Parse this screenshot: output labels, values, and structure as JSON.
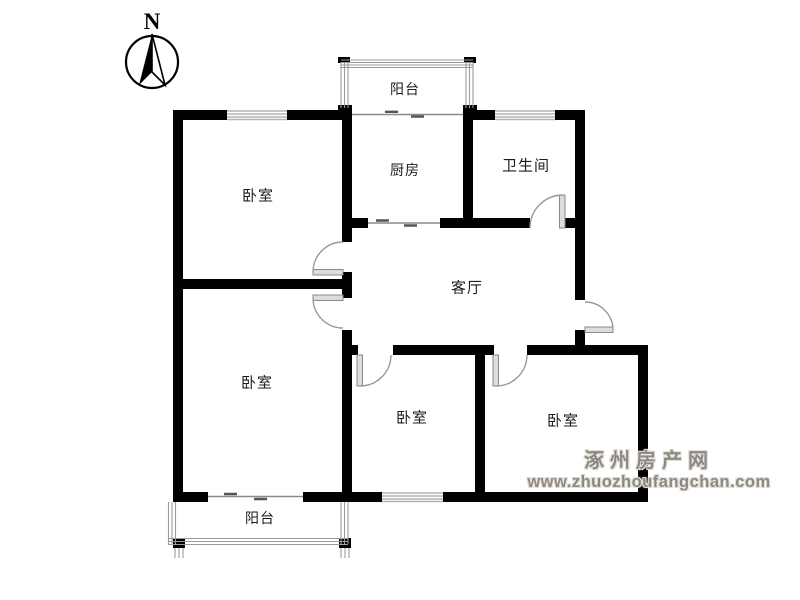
{
  "page": {
    "background": "#ffffff",
    "type": "apartment floor plan"
  },
  "compass": {
    "label": "N"
  },
  "rooms": [
    {
      "id": "balcony-north",
      "label": "阳台"
    },
    {
      "id": "kitchen",
      "label": "厨房"
    },
    {
      "id": "bathroom",
      "label": "卫生间"
    },
    {
      "id": "bedroom-northwest",
      "label": "卧室"
    },
    {
      "id": "living-room",
      "label": "客厅"
    },
    {
      "id": "bedroom-southwest",
      "label": "卧室"
    },
    {
      "id": "bedroom-south",
      "label": "卧室"
    },
    {
      "id": "bedroom-southeast",
      "label": "卧室"
    },
    {
      "id": "balcony-south",
      "label": "阳台"
    }
  ],
  "watermark": {
    "site_name": "涿州房产网",
    "site_url": "www.zhuozhoufangchan.com"
  },
  "colors": {
    "wall": "#000000",
    "door_arc": "#999999",
    "door_panel": "#d9d9d9",
    "window": "#b3b3b3",
    "watermark_text": "#8e8880"
  }
}
